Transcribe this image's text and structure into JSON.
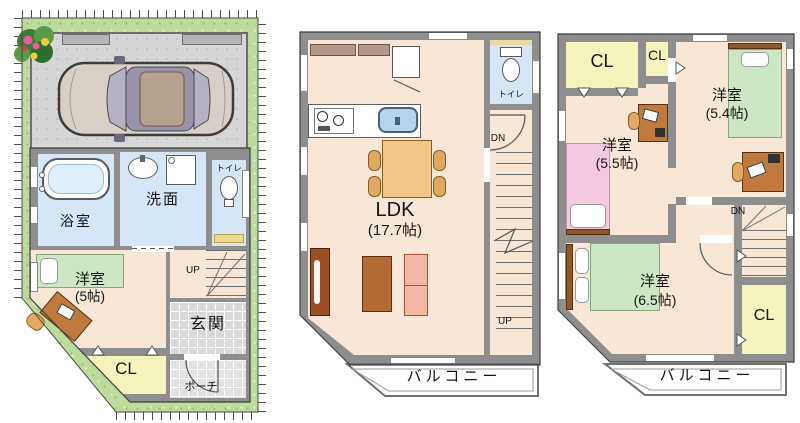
{
  "palette": {
    "wall_gray": "#8e8e8e",
    "floor_peach": "#f8e6d6",
    "water_blue": "#d5e7f6",
    "closet_yellow": "#f4f3bc",
    "lot_green": "#bedb9e",
    "tile_gray": "#d9d9d9",
    "bed_green": "#cde6c4",
    "bed_pink": "#f6c9e0",
    "sofa_salmon": "#f3b7a4",
    "wood_brown": "#c07a3e",
    "wood_dark_brown": "#9b4f26",
    "table_tan": "#f2c689"
  },
  "floor1": {
    "bath": "浴室",
    "washroom": "洗面",
    "toilet": "トイレ",
    "bedroom_name": "洋室",
    "bedroom_size": "(5帖)",
    "closet": "CL",
    "entrance": "玄関",
    "porch": "ポーチ",
    "stairs_up": "UP"
  },
  "floor2": {
    "toilet": "トイレ",
    "ldk_name": "LDK",
    "ldk_size": "(17.7帖)",
    "balcony": "バルコニー",
    "stairs_dn": "DN",
    "stairs_up": "UP"
  },
  "floor3": {
    "closet1": "CL",
    "closet2": "CL",
    "closet3": "CL",
    "bedroom54_name": "洋室",
    "bedroom54_size": "(5.4帖)",
    "bedroom55_name": "洋室",
    "bedroom55_size": "(5.5帖)",
    "bedroom65_name": "洋室",
    "bedroom65_size": "(6.5帖)",
    "balcony": "バルコニー",
    "stairs_dn": "DN"
  }
}
